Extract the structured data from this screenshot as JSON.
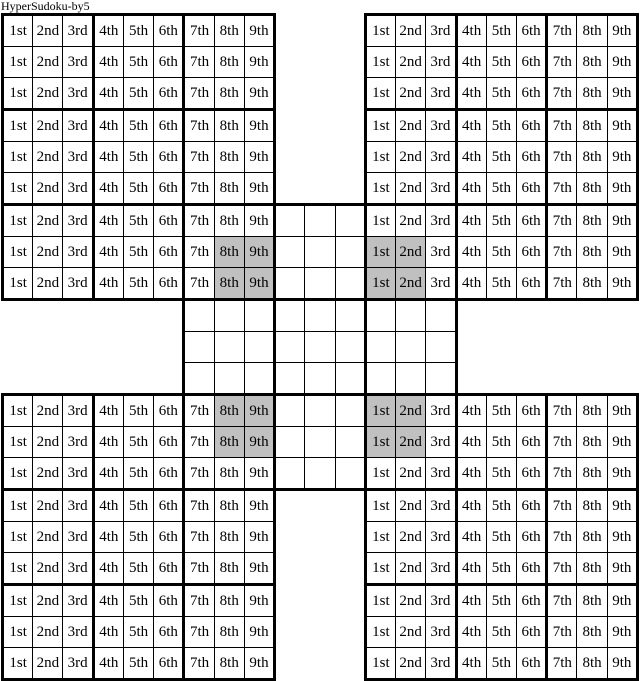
{
  "title": "HyperSudoku-by5",
  "colors": {
    "background": "#ffffff",
    "cell_bg": "#ffffff",
    "shaded_cell": "#c0c0c0",
    "grid_line": "#000000",
    "text": "#000000"
  },
  "board": {
    "size": 21,
    "block": 3,
    "grid_span": 9,
    "column_labels": [
      "1st",
      "2nd",
      "3rd",
      "4th",
      "5th",
      "6th",
      "7th",
      "8th",
      "9th"
    ],
    "grids": [
      {
        "name": "top-left",
        "row": 1,
        "col": 1,
        "labeled": true
      },
      {
        "name": "top-right",
        "row": 1,
        "col": 13,
        "labeled": true
      },
      {
        "name": "center",
        "row": 7,
        "col": 7,
        "labeled": false
      },
      {
        "name": "bottom-left",
        "row": 13,
        "col": 1,
        "labeled": true
      },
      {
        "name": "bottom-right",
        "row": 13,
        "col": 13,
        "labeled": true
      }
    ],
    "shaded_cells": [
      {
        "row": 8,
        "col": 8
      },
      {
        "row": 8,
        "col": 9
      },
      {
        "row": 9,
        "col": 8
      },
      {
        "row": 9,
        "col": 9
      },
      {
        "row": 8,
        "col": 13
      },
      {
        "row": 8,
        "col": 14
      },
      {
        "row": 9,
        "col": 13
      },
      {
        "row": 9,
        "col": 14
      },
      {
        "row": 13,
        "col": 8
      },
      {
        "row": 13,
        "col": 9
      },
      {
        "row": 14,
        "col": 8
      },
      {
        "row": 14,
        "col": 9
      },
      {
        "row": 13,
        "col": 13
      },
      {
        "row": 13,
        "col": 14
      },
      {
        "row": 14,
        "col": 13
      },
      {
        "row": 14,
        "col": 14
      }
    ]
  }
}
